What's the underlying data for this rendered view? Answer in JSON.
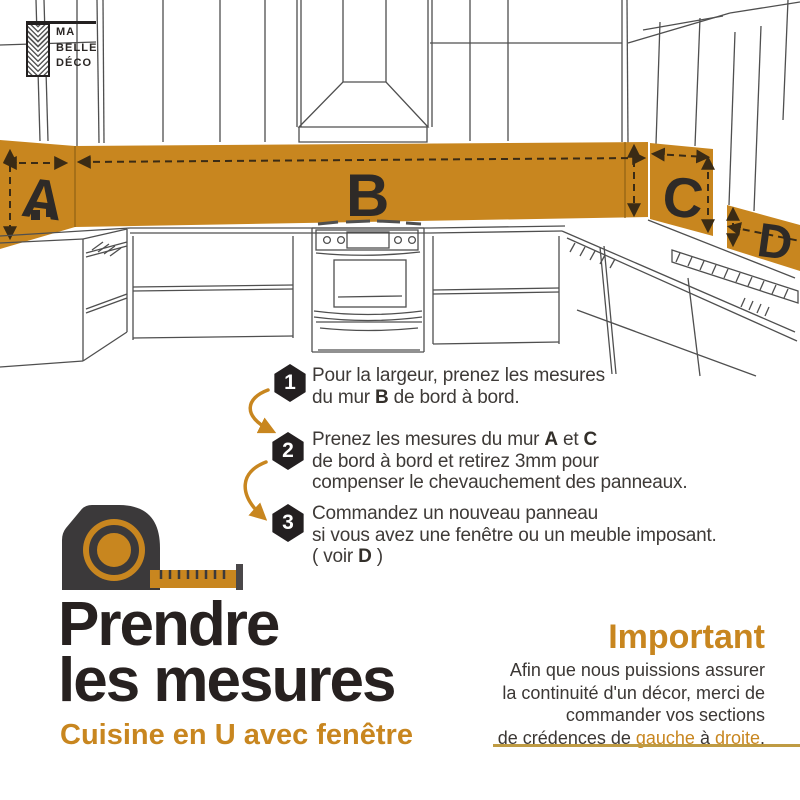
{
  "logo": {
    "lines": [
      "MA",
      "BELLE",
      "DÉCO"
    ]
  },
  "colors": {
    "accent": "#c8861f",
    "dark": "#2b2523",
    "gold_line": "#bf9b43",
    "sketch_line": "#4f4f4f",
    "badge": "#231f20"
  },
  "diagram": {
    "labels": {
      "a": "A",
      "b": "B",
      "c": "C",
      "d": "D"
    }
  },
  "steps": [
    {
      "number": "1",
      "lines": [
        [
          {
            "t": "Pour la largeur, prenez les mesures"
          }
        ],
        [
          {
            "t": "du mur "
          },
          {
            "t": "B",
            "b": true
          },
          {
            "t": " de bord à bord."
          }
        ]
      ]
    },
    {
      "number": "2",
      "lines": [
        [
          {
            "t": "Prenez les mesures du mur "
          },
          {
            "t": "A",
            "b": true
          },
          {
            "t": " et "
          },
          {
            "t": "C",
            "b": true
          }
        ],
        [
          {
            "t": "de bord à bord et retirez 3mm pour"
          }
        ],
        [
          {
            "t": "compenser le chevauchement des panneaux."
          }
        ]
      ]
    },
    {
      "number": "3",
      "lines": [
        [
          {
            "t": "Commandez un nouveau panneau"
          }
        ],
        [
          {
            "t": "si vous avez une fenêtre ou un meuble imposant."
          }
        ],
        [
          {
            "t": "( voir "
          },
          {
            "t": "D",
            "b": true
          },
          {
            "t": " )"
          }
        ]
      ]
    }
  ],
  "title": {
    "line1": "Prendre",
    "line2": "les mesures",
    "subtitle": "Cuisine en U avec fenêtre"
  },
  "important": {
    "heading": "Important",
    "lines": [
      [
        {
          "t": "Afin que nous puissions assurer"
        }
      ],
      [
        {
          "t": "la continuité d'un décor, merci de"
        }
      ],
      [
        {
          "t": "commander vos sections"
        }
      ],
      [
        {
          "t": "de crédences de "
        },
        {
          "t": "gauche",
          "o": true
        },
        {
          "t": " à "
        },
        {
          "t": "droite",
          "o": true
        },
        {
          "t": "."
        }
      ]
    ]
  }
}
